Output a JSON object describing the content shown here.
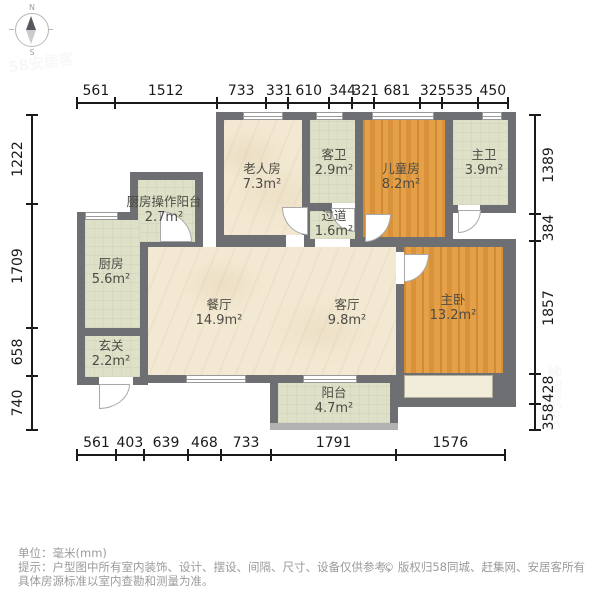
{
  "colors": {
    "wall": "#6d6f72",
    "cream": "#f3e9d2",
    "green": "#dee0c8",
    "orange": "#e2993e",
    "rail": "#b2b2b2",
    "bay": "#f2edda",
    "dim_text": "#1a1a1a",
    "note_text": "#9b9b9b",
    "label_text": "#4c4b44",
    "watermark": "#888888"
  },
  "compass": {
    "north": "N",
    "south": "S"
  },
  "rulers": {
    "top": [
      561,
      1512,
      733,
      331,
      610,
      344,
      321,
      681,
      325,
      535,
      450
    ],
    "bottom": [
      561,
      403,
      639,
      468,
      733,
      1791,
      1576
    ],
    "left": [
      1222,
      1709,
      658,
      740
    ],
    "right": [
      1389,
      384,
      1857,
      428,
      358
    ]
  },
  "rooms": [
    {
      "id": "kitchen-operation-balcony",
      "name": "厨房操作阳台",
      "area": "2.7m²"
    },
    {
      "id": "elder-room",
      "name": "老人房",
      "area": "7.3m²"
    },
    {
      "id": "guest-bathroom",
      "name": "客卫",
      "area": "2.9m²"
    },
    {
      "id": "children-room",
      "name": "儿童房",
      "area": "8.2m²"
    },
    {
      "id": "master-bathroom",
      "name": "主卫",
      "area": "3.9m²"
    },
    {
      "id": "hallway",
      "name": "过道",
      "area": "1.6m²"
    },
    {
      "id": "kitchen",
      "name": "厨房",
      "area": "5.6m²"
    },
    {
      "id": "dining-room",
      "name": "餐厅",
      "area": "14.9m²"
    },
    {
      "id": "living-room",
      "name": "客厅",
      "area": "9.8m²"
    },
    {
      "id": "master-bedroom",
      "name": "主卧",
      "area": "13.2m²"
    },
    {
      "id": "entry",
      "name": "玄关",
      "area": "2.2m²"
    },
    {
      "id": "balcony",
      "name": "阳台",
      "area": "4.7m²"
    }
  ],
  "footer": {
    "unit_note": "单位：毫米(mm)",
    "tip_line1": "提示：户型图中所有室内装饰、设计、摆设、间隔、尺寸、设备仅供参考，",
    "tip_line2": "具体房源标准以室内查勘和测量为准。",
    "copyright": "© 版权归58同城、赶集网、安居客所有"
  },
  "watermark": "58安居客"
}
